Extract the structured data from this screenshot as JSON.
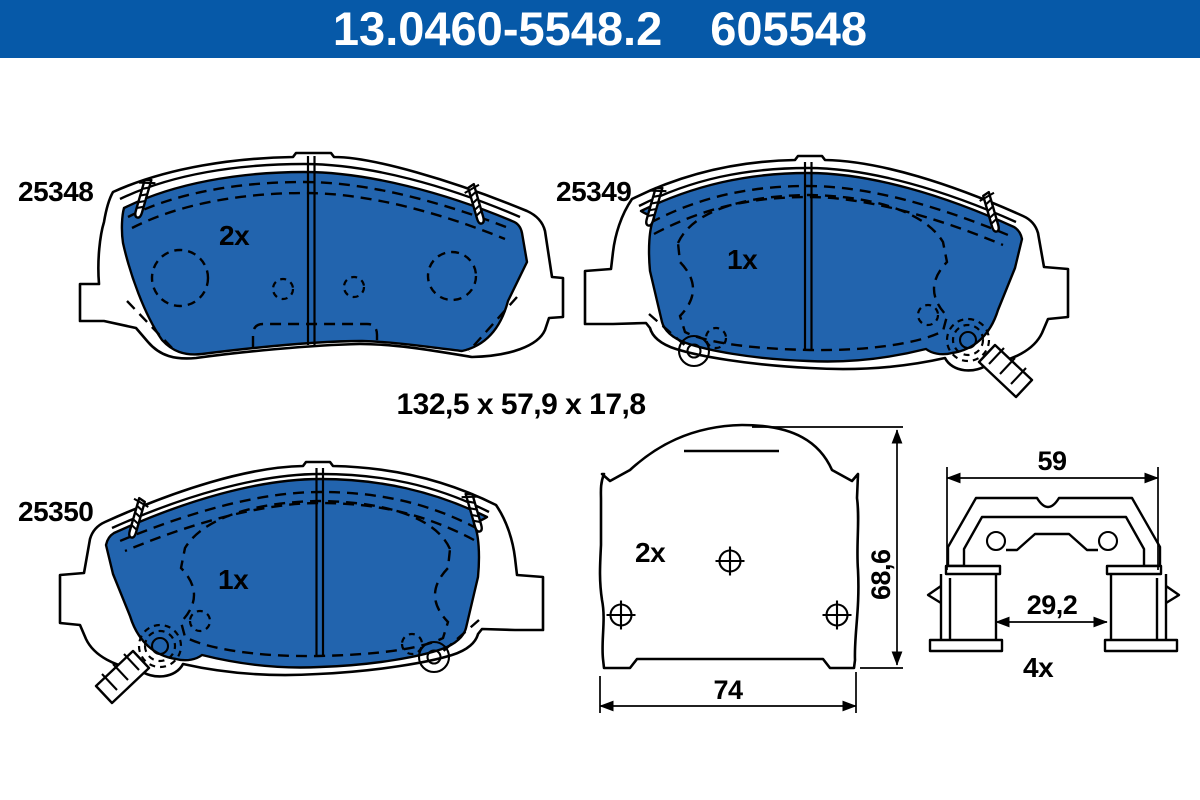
{
  "header": {
    "catalog_number": "13.0460-5548.2",
    "article_number": "605548"
  },
  "colors": {
    "header_bg": "#0659a8",
    "pad_fill": "#2264ae",
    "line_color": "#000000",
    "header_text": "#ffffff",
    "page_bg": "#ffffff"
  },
  "overall_dimensions": "132,5 x 57,9 x 17,8",
  "pads": {
    "top_left": {
      "label": "25348",
      "quantity": "2x"
    },
    "top_right": {
      "label": "25349",
      "quantity": "1x"
    },
    "bottom_left": {
      "label": "25350",
      "quantity": "1x"
    }
  },
  "backplate_view": {
    "quantity": "2x",
    "height": "68,6",
    "width": "74"
  },
  "accessory_clip": {
    "quantity": "4x",
    "width": "59",
    "inner_width": "29,2"
  }
}
